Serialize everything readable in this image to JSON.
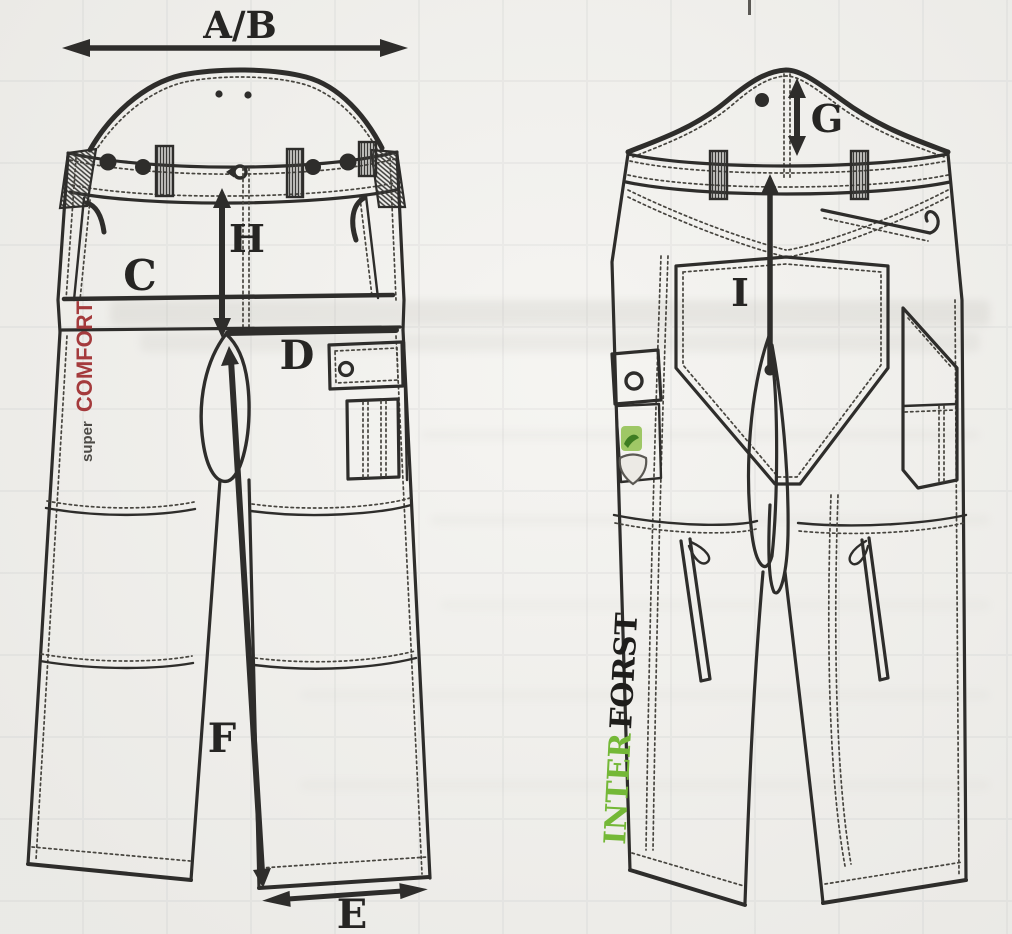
{
  "measurements": {
    "ab": "A/B",
    "c": "C",
    "d": "D",
    "e": "E",
    "f": "F",
    "g": "G",
    "h": "H",
    "i": "I"
  },
  "branding": {
    "front_small": "super",
    "front_main": "COMFORT",
    "back_green": "INTER",
    "back_dark": "FORST"
  },
  "colors": {
    "ink": "#2e2d2b",
    "paper": "#f2f1ed",
    "comfort_red": "#a43a3c",
    "inter_green": "#74b837",
    "forst_dark": "#1e1d1b"
  }
}
